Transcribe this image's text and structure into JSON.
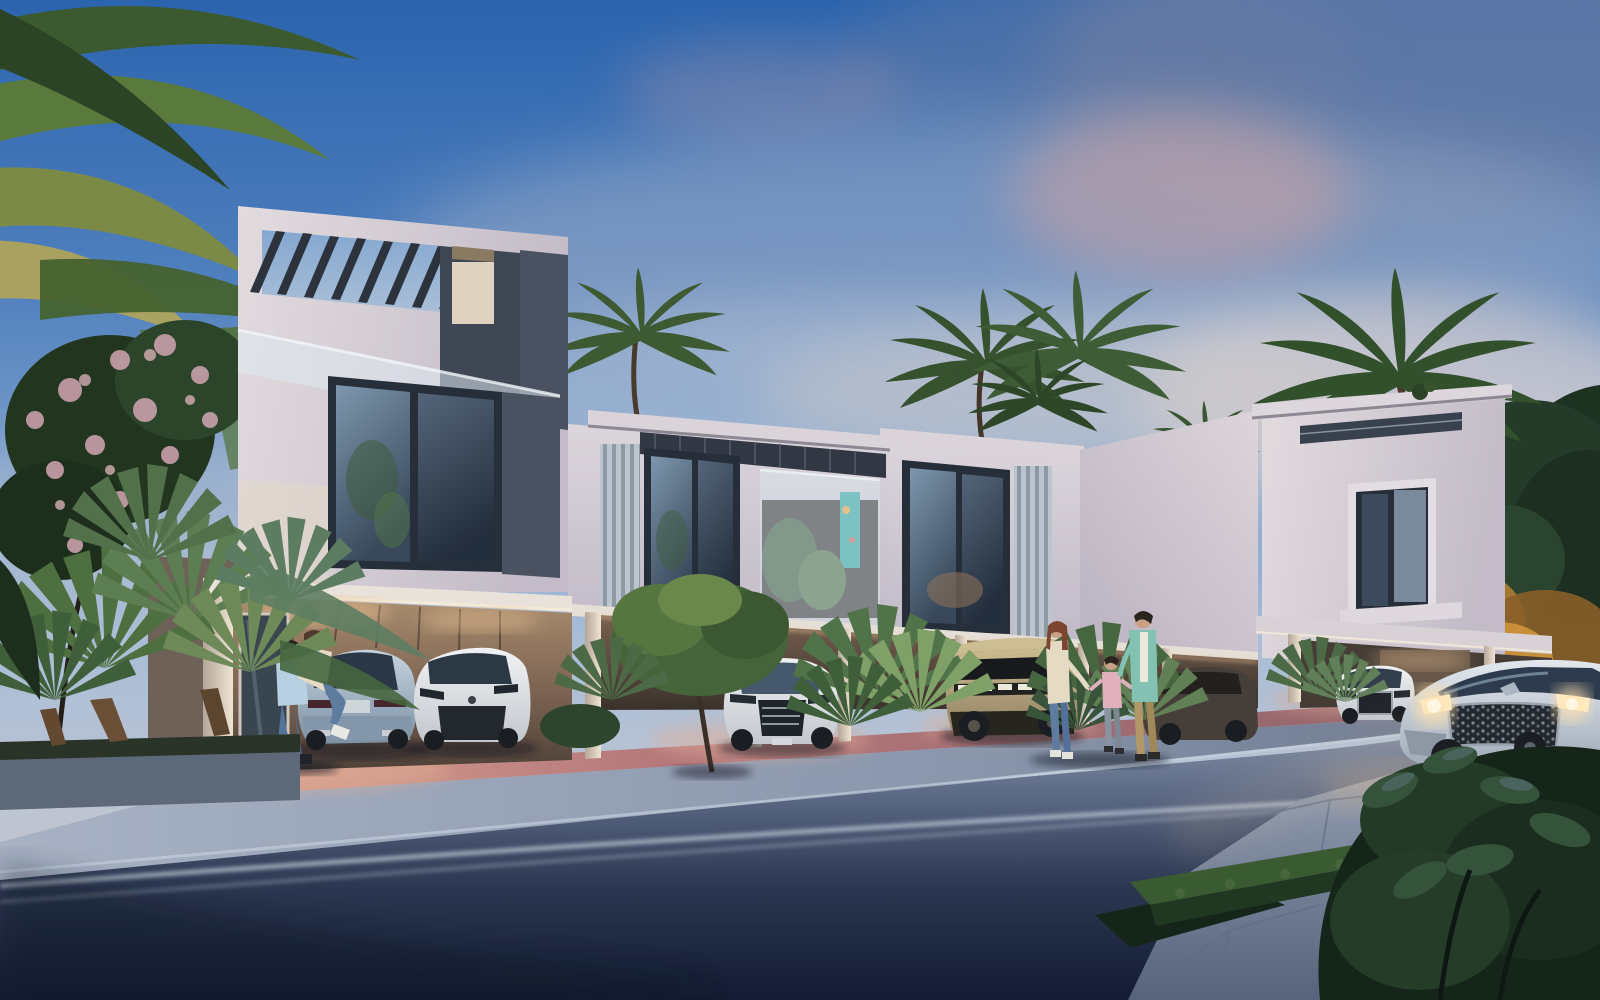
{
  "scene": {
    "setting": "Modern two-storey townhouse row with open carports at dusk",
    "time_of_day": "dusk",
    "sky": "blue gradient with slate, lavender and pink cloud bands",
    "ground": "dark asphalt street with white lane lines, grey sidewalk, pink paver driveway aprons, flagstone walk at bottom right"
  },
  "building": {
    "storeys": 2,
    "left_tower": "three-storey end unit with rooftop pergola of dark louvers, frosted glass balustrade and tall dark-framed windows",
    "mid_row": "two-storey units with louvered roof canopies, vertical slat screens, glass balconies with plants and a turquoise artwork",
    "right_tower": "end unit with protruding window box and roof slab",
    "ground_floor": "open carports with warm lighting between slim white columns"
  },
  "vehicles": [
    {
      "name": "coupe-suv-rear",
      "color": "silver-blue",
      "location": "left carport"
    },
    {
      "name": "compact-suv-front",
      "color": "white",
      "location": "left carport"
    },
    {
      "name": "luxury-suv-front",
      "color": "white",
      "location": "center carport"
    },
    {
      "name": "electric-truck",
      "color": "sand",
      "location": "center-right carport"
    },
    {
      "name": "dark-suv-side",
      "color": "dark grey-brown",
      "location": "behind family"
    },
    {
      "name": "small-suv-front",
      "color": "white",
      "location": "right carport"
    },
    {
      "name": "driving-suv",
      "color": "silver",
      "location": "street, headlights on"
    }
  ],
  "people": [
    {
      "name": "embracing-couple",
      "detail": "man in light blue shirt and jeans lifting woman in beige top",
      "location": "left carport"
    },
    {
      "name": "family-of-three",
      "detail": "mother in cream top and jeans, child in pink, father in teal shirt and khaki pants",
      "location": "walking toward street at right-center"
    }
  ],
  "vegetation": [
    {
      "name": "foreground-palm-fronds",
      "location": "top left"
    },
    {
      "name": "flowering-tree",
      "detail": "pink blossoms",
      "location": "left"
    },
    {
      "name": "fan-palm-planter",
      "location": "bottom left"
    },
    {
      "name": "round-tree",
      "location": "in front of white luxury SUV"
    },
    {
      "name": "palm-crowns",
      "location": "behind roofline"
    },
    {
      "name": "uplit-golden-trees",
      "location": "right of right tower"
    },
    {
      "name": "hedge-planter",
      "location": "bottom right walk"
    },
    {
      "name": "foreground-bush",
      "location": "bottom right corner"
    }
  ],
  "palette": {
    "sky_top": "#2b64ae",
    "sky_mid": "#a9bdd6",
    "sky_horizon": "#cfc3c4",
    "cloud_slate": "#6c7da3",
    "cloud_light": "#9fadc6",
    "cloud_pink": "#d3a3a2",
    "cloud_cream": "#e3d4cf",
    "facade": "#d6cfd6",
    "facade_shade": "#b3aebc",
    "facade_warm": "#e7d9c5",
    "panel_dark": "#3f4654",
    "frame_dark": "#262e3a",
    "glass": "#45586c",
    "glass_sky": "#7e97ae",
    "louver": "#2c333d",
    "column": "#d8d0cc",
    "interior_warm": "#6b5747",
    "interior_glow": "#e9c193",
    "paver_pink": "#b5787c",
    "paver_lit": "#e2ae95",
    "sidewalk": "#93a0b5",
    "street_near": "#16203a",
    "road_line": "#cdd6e2",
    "stone_walk": "#8b97ad",
    "stone_line": "#5f6b84",
    "leaf_dark": "#1e3222",
    "leaf_mid": "#33512f",
    "leaf_light": "#5d7b44",
    "palm_olive": "#7c8a48",
    "palm_yellow": "#b3a556",
    "warm_foliage": "#b9802f",
    "flower": "#c9a0ab",
    "hedge_top": "#3a5a31",
    "hedge_front": "#203722",
    "grass_dark": "#16251a",
    "car_silver": "#c3ccd6",
    "car_white": "#e9ebec",
    "car_steel": "#9db0c2",
    "car_sand": "#b4a377",
    "car_dark": "#453e39",
    "tire": "#1a1d22",
    "headlight": "#ffe2ad",
    "skin": "#c9a083",
    "hair_dark": "#2a241f",
    "hair_auburn": "#7c452f",
    "shirt_blue": "#b7d0e2",
    "shirt_teal": "#83c1b2",
    "shirt_cream": "#e5dac4",
    "shirt_pink": "#e0b1bc",
    "jeans": "#5e7ca0",
    "khaki": "#b29868"
  }
}
